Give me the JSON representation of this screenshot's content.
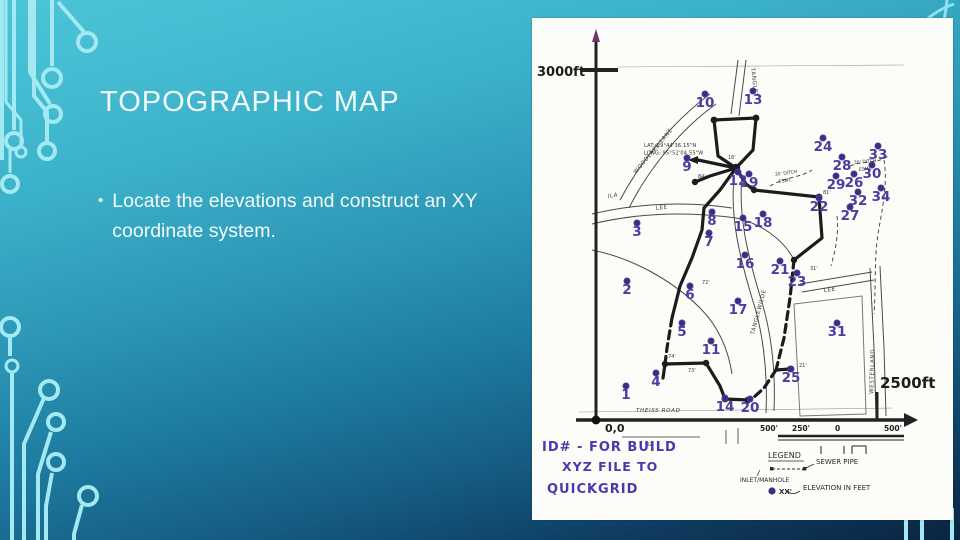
{
  "slide": {
    "title": "TOPOGRAPHIC MAP",
    "bullet_marker": "•",
    "bullet": "Locate the elevations and construct an XY coordinate system.",
    "colors": {
      "background_top": "#4cc5d8",
      "background_bottom": "#0a2440",
      "circuit_trace": "#a3e9f2",
      "text": "#f2fafc",
      "marker_purple": "#4b3da0"
    }
  },
  "map": {
    "axis": {
      "y_label": "3000ft",
      "x_label": "2500ft",
      "origin_label": "0,0"
    },
    "lat_long_lines": [
      "LAT: 29°44'36.15\"N",
      "LONG: 95°52'04.55\"W"
    ],
    "streets": [
      {
        "name": "WOODLAKE  LANE",
        "x": 104,
        "y": 156,
        "rot": -50
      },
      {
        "name": "TANGLEY",
        "x": 219,
        "y": 50,
        "rot": 83
      },
      {
        "name": "ILA",
        "x": 76,
        "y": 180,
        "rot": -9,
        "italic": true
      },
      {
        "name": "LEE",
        "x": 124,
        "y": 192,
        "rot": -7
      },
      {
        "name": "TANGLEWILDE",
        "x": 222,
        "y": 317,
        "rot": -75
      },
      {
        "name": "LEE",
        "x": 292,
        "y": 274,
        "rot": -6
      },
      {
        "name": "WESTERLAND",
        "x": 341,
        "y": 376,
        "rot": -88
      },
      {
        "name": "THEISS  ROAD",
        "x": 104,
        "y": 394,
        "rot": 0,
        "italic": true
      }
    ],
    "ditch_labels": [
      {
        "t": "30' DITCH",
        "x": 243,
        "y": 158,
        "rot": -8
      },
      {
        "t": "ESMT.",
        "x": 247,
        "y": 165,
        "rot": -8
      },
      {
        "t": "30' DITCH",
        "x": 322,
        "y": 146,
        "rot": -5
      },
      {
        "t": "ESMT.",
        "x": 327,
        "y": 153,
        "rot": -5
      }
    ],
    "points": [
      {
        "id": "1",
        "x": 94,
        "y": 380
      },
      {
        "id": "2",
        "x": 95,
        "y": 275
      },
      {
        "id": "3",
        "x": 105,
        "y": 217
      },
      {
        "id": "4",
        "x": 124,
        "y": 367
      },
      {
        "id": "5",
        "x": 150,
        "y": 317
      },
      {
        "id": "6",
        "x": 158,
        "y": 280
      },
      {
        "id": "7",
        "x": 177,
        "y": 227
      },
      {
        "id": "8",
        "x": 180,
        "y": 206
      },
      {
        "id": "9",
        "x": 155,
        "y": 152
      },
      {
        "id": "10",
        "x": 173,
        "y": 88
      },
      {
        "id": "11",
        "x": 179,
        "y": 335
      },
      {
        "id": "12",
        "x": 206,
        "y": 166
      },
      {
        "id": "13",
        "x": 221,
        "y": 85
      },
      {
        "id": "14",
        "x": 193,
        "y": 392
      },
      {
        "id": "15",
        "x": 211,
        "y": 212
      },
      {
        "id": "16",
        "x": 213,
        "y": 249
      },
      {
        "id": "17",
        "x": 206,
        "y": 295
      },
      {
        "id": "18",
        "x": 231,
        "y": 208
      },
      {
        "id": "19",
        "x": 217,
        "y": 168
      },
      {
        "id": "20",
        "x": 218,
        "y": 393
      },
      {
        "id": "21",
        "x": 248,
        "y": 255
      },
      {
        "id": "22",
        "x": 287,
        "y": 192
      },
      {
        "id": "23",
        "x": 265,
        "y": 267
      },
      {
        "id": "24",
        "x": 291,
        "y": 132
      },
      {
        "id": "25",
        "x": 259,
        "y": 363
      },
      {
        "id": "26",
        "x": 322,
        "y": 168
      },
      {
        "id": "27",
        "x": 318,
        "y": 201
      },
      {
        "id": "28",
        "x": 310,
        "y": 151
      },
      {
        "id": "29",
        "x": 304,
        "y": 170
      },
      {
        "id": "30",
        "x": 340,
        "y": 159
      },
      {
        "id": "31",
        "x": 305,
        "y": 317
      },
      {
        "id": "32",
        "x": 326,
        "y": 186
      },
      {
        "id": "33",
        "x": 346,
        "y": 140
      },
      {
        "id": "34",
        "x": 349,
        "y": 182
      }
    ],
    "length_labels": [
      {
        "t": "16'",
        "x": 196,
        "y": 141
      },
      {
        "t": "84'",
        "x": 166,
        "y": 160
      },
      {
        "t": "74'",
        "x": 136,
        "y": 340
      },
      {
        "t": "73'",
        "x": 156,
        "y": 354
      },
      {
        "t": "81'",
        "x": 291,
        "y": 176
      },
      {
        "t": "31'",
        "x": 278,
        "y": 252
      },
      {
        "t": "21'",
        "x": 267,
        "y": 349
      },
      {
        "t": "72'",
        "x": 170,
        "y": 266
      },
      {
        "t": "42'",
        "x": 114,
        "y": 428
      }
    ],
    "scale_labels": [
      {
        "t": "500'",
        "x": 228
      },
      {
        "t": "250'",
        "x": 260
      },
      {
        "t": "0",
        "x": 303
      },
      {
        "t": "500'",
        "x": 352
      }
    ],
    "legend": {
      "title": "LEGEND",
      "sewer": "SEWER PIPE",
      "inlet": "INLET/MANHOLE",
      "elev_prefix": "XX'",
      "elev_text": "ELEVATION IN FEET"
    },
    "note_lines": [
      {
        "t": "ID# - FOR BUILD",
        "x": 10,
        "y": 433,
        "size": 13
      },
      {
        "t": "XYZ FILE TO",
        "x": 30,
        "y": 453,
        "size": 12.5
      },
      {
        "t": "QUICKGRID",
        "x": 15,
        "y": 475,
        "size": 13
      }
    ]
  }
}
